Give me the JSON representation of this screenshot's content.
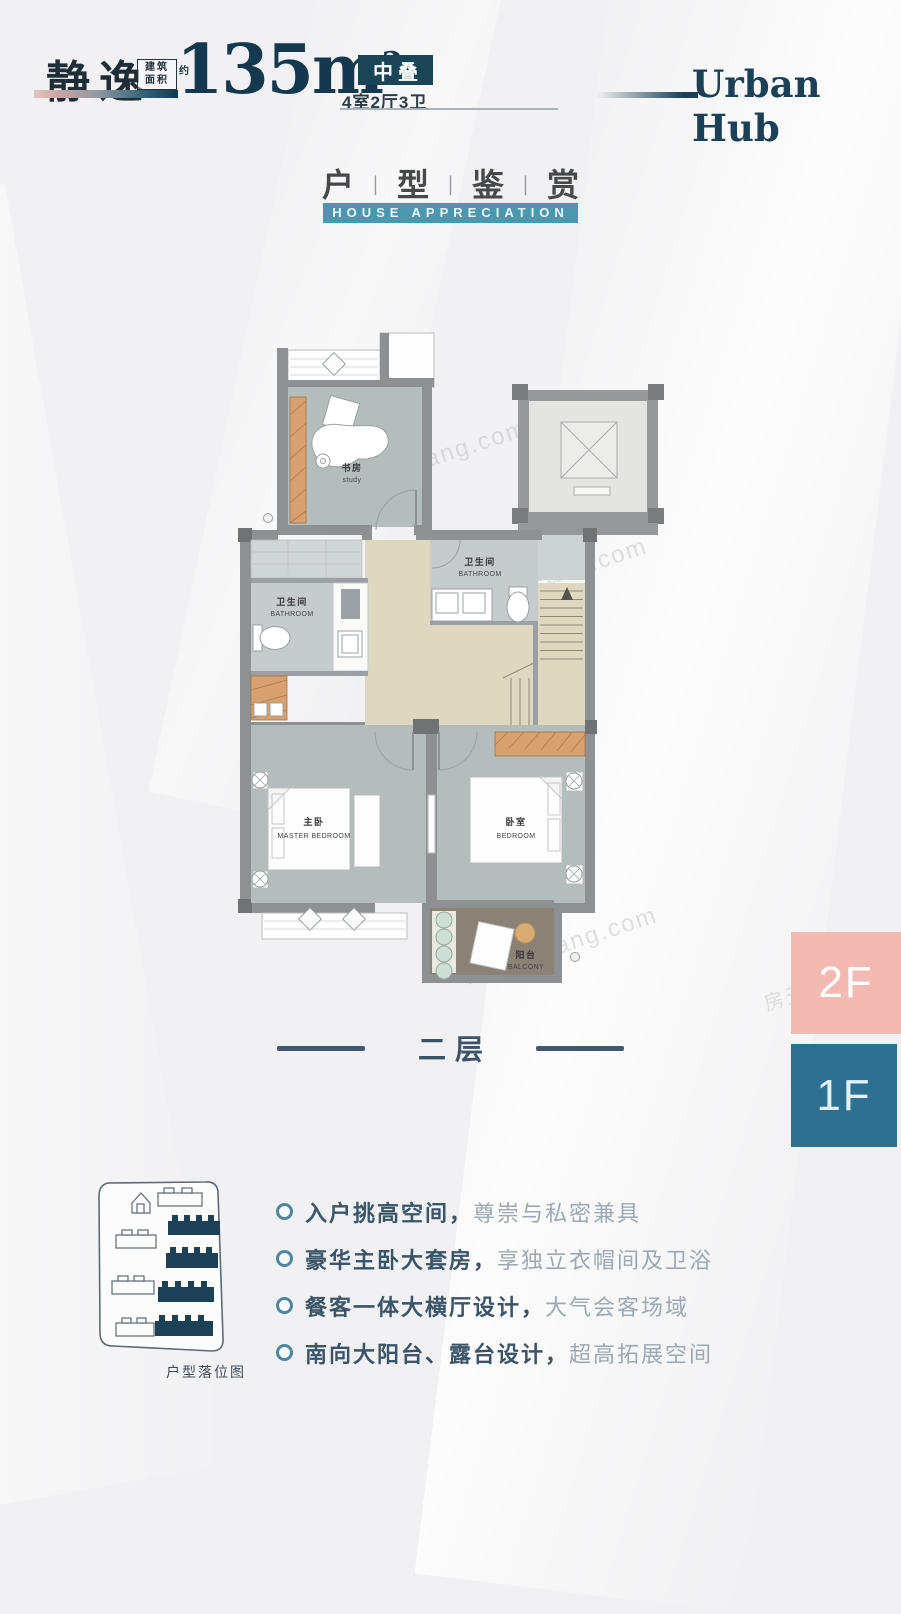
{
  "header": {
    "name": "静逸",
    "area_label_line1": "建筑",
    "area_label_line2": "面积",
    "area_label_suffix": "约",
    "area_value": "135m",
    "area_sup": "2",
    "type_badge": "中叠",
    "layout": "4室2厅3卫",
    "brand": "Urban Hub"
  },
  "section": {
    "title_chars": [
      "户",
      "型",
      "鉴",
      "赏"
    ],
    "sep": "丨",
    "subtitle": "HOUSE APPRECIATION"
  },
  "plan": {
    "floor_label": "二层",
    "watermark": "房天下Fang.com",
    "rooms": {
      "study": {
        "zh": "书房",
        "en": "study"
      },
      "bathroom_left": {
        "zh": "卫生间",
        "en": "BATHROOM"
      },
      "bathroom_right": {
        "zh": "卫生间",
        "en": "BATHROOM"
      },
      "master": {
        "zh": "主卧",
        "en": "MASTER BEDROOM"
      },
      "bedroom": {
        "zh": "卧室",
        "en": "BEDROOM"
      },
      "balcony": {
        "zh": "阳台",
        "en": "BALCONY"
      }
    }
  },
  "floor_badges": [
    {
      "label": "2F",
      "color": "#f3bab3"
    },
    {
      "label": "1F",
      "color": "#2d7092"
    }
  ],
  "site_map": {
    "caption": "户型落位图"
  },
  "features": [
    {
      "bold": "入户挑高空间，",
      "light": "尊崇与私密兼具"
    },
    {
      "bold": "豪华主卧大套房，",
      "light": "享独立衣帽间及卫浴"
    },
    {
      "bold": "餐客一体大横厅设计，",
      "light": "大气会客场域"
    },
    {
      "bold": "南向大阳台、露台设计，",
      "light": "超高拓展空间"
    }
  ],
  "colors": {
    "accent_teal": "#1c4156",
    "badge_bg": "#1a4556",
    "subtitle_bg": "#4a97ae",
    "floor2_pink": "#f3bab3",
    "floor1_teal": "#2d7092",
    "hall_beige": "#ded8c1",
    "room_gray_green": "#b2bdbc",
    "closet_orange": "#d7a172",
    "balcony_brown": "#8b8276"
  }
}
